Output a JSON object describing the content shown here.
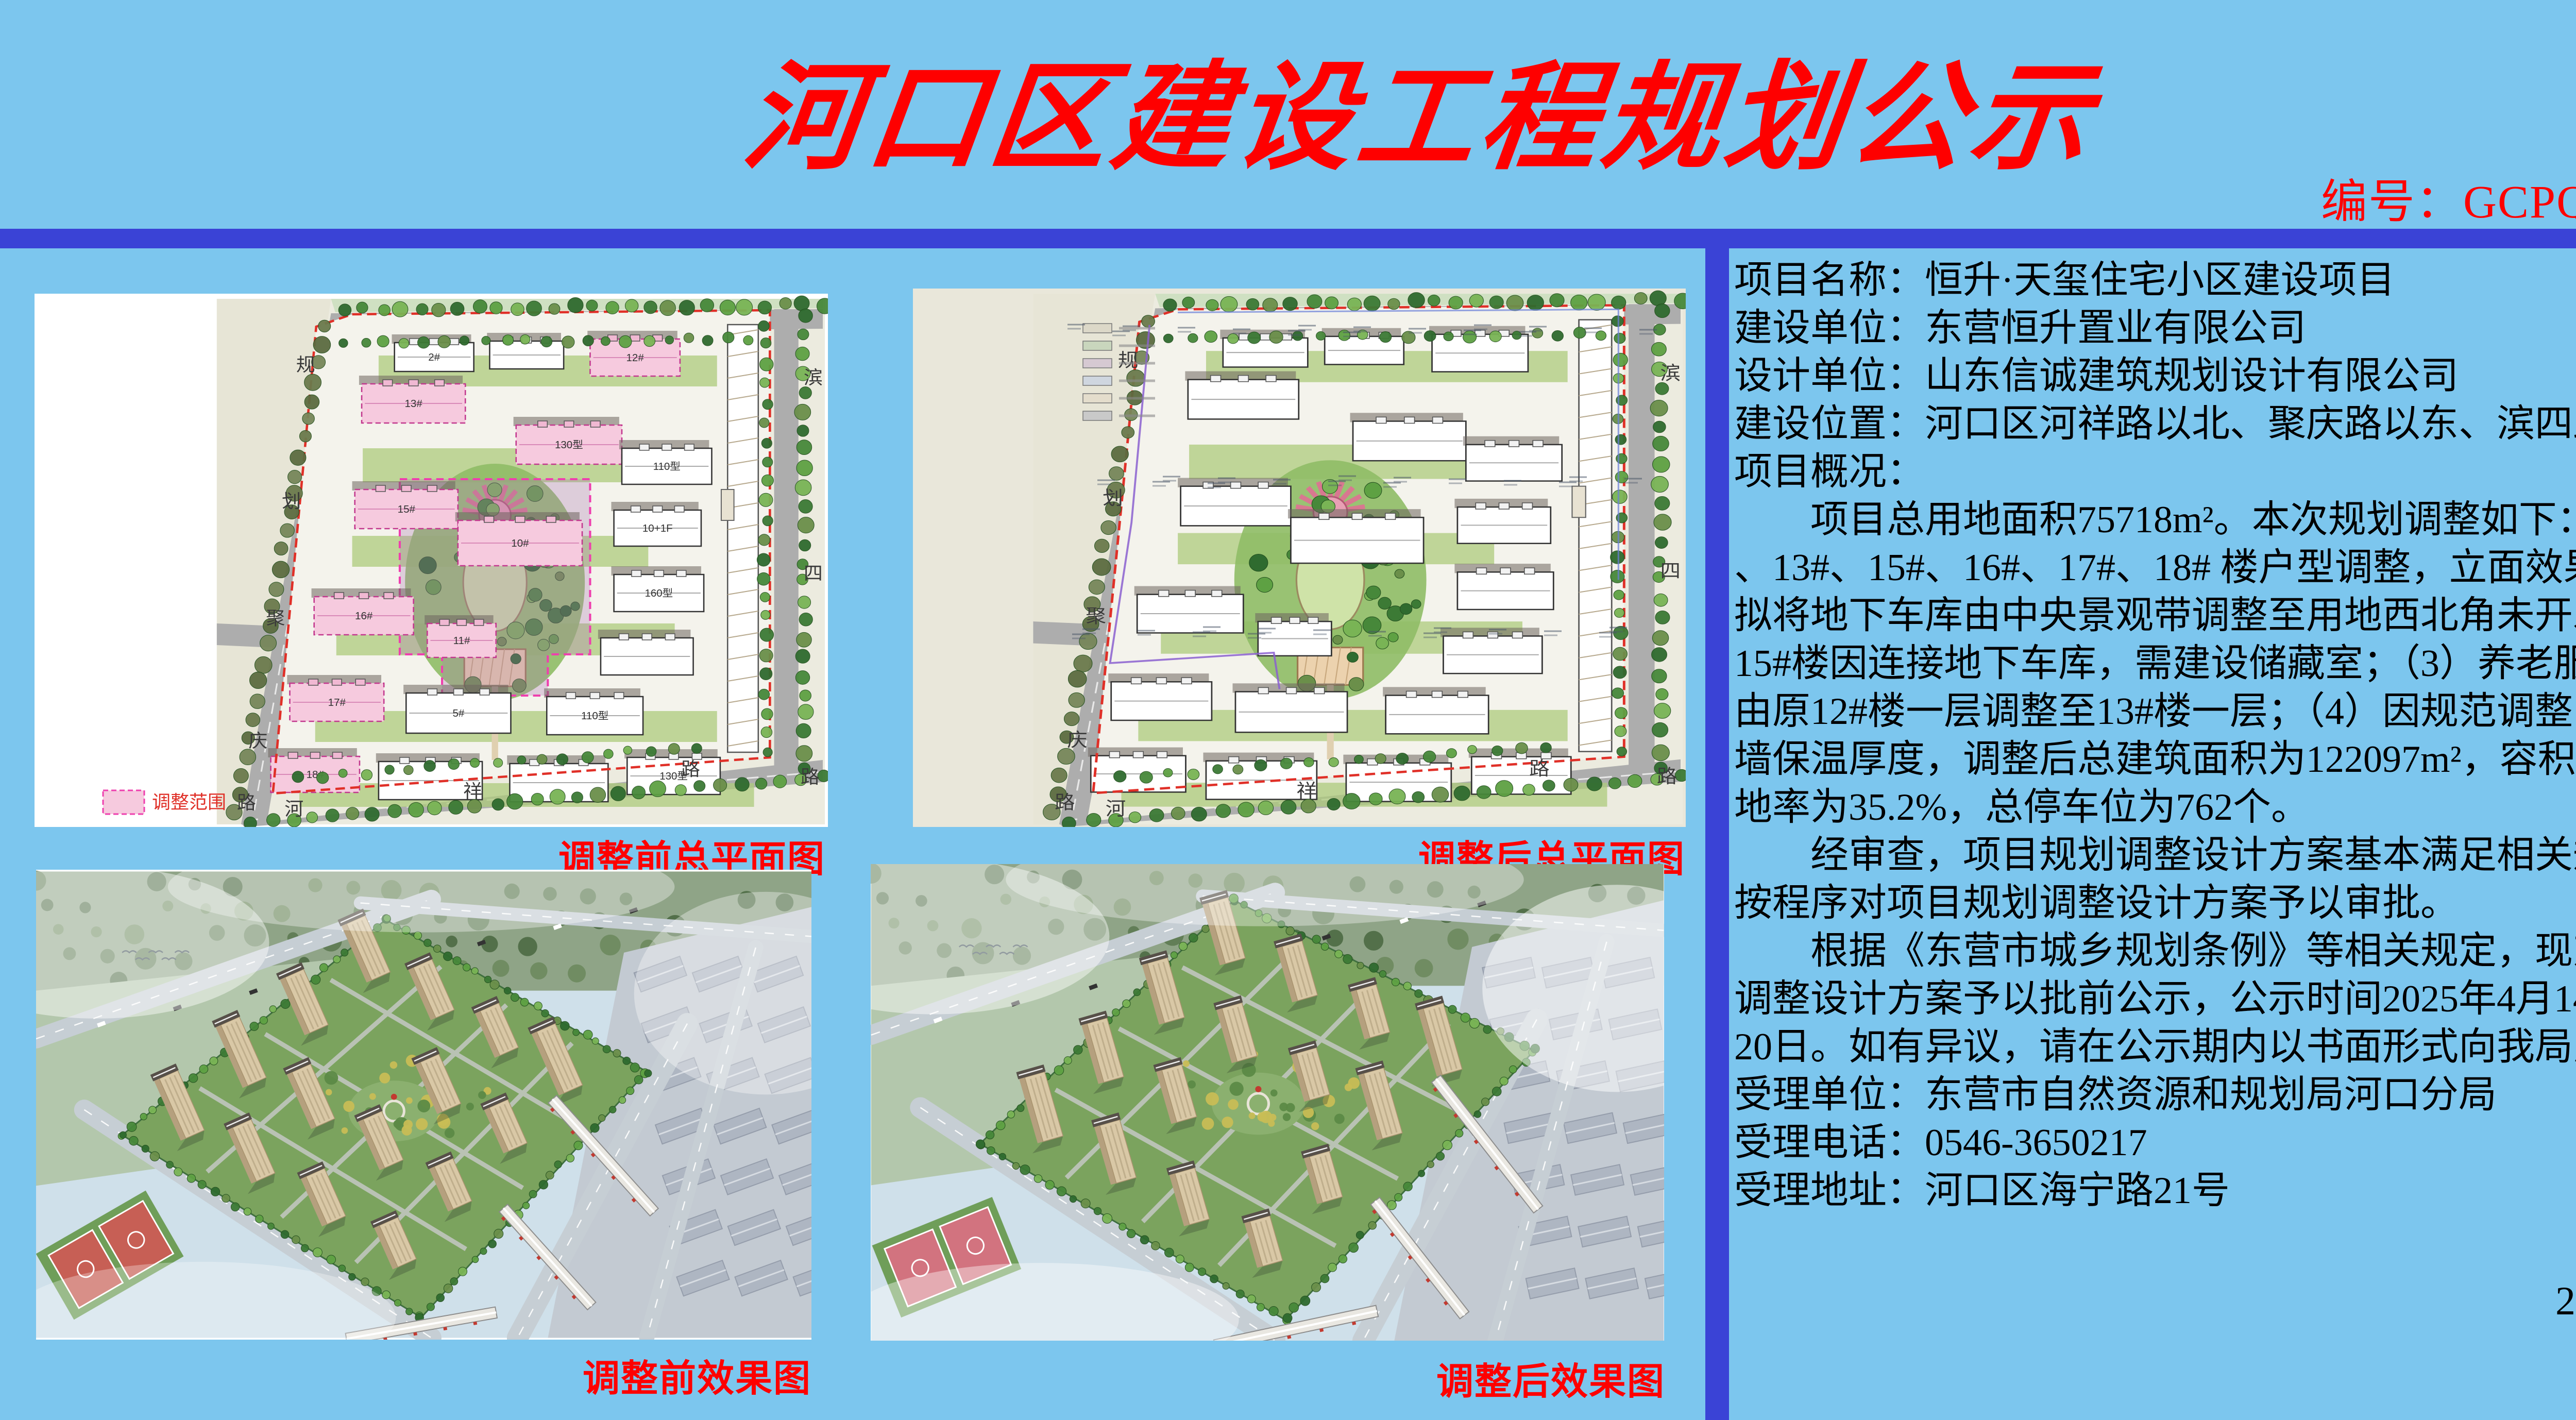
{
  "header": {
    "title": "河口区建设工程规划公示",
    "serial": "编号：GCPQ2025015"
  },
  "panels": {
    "plan_before": {
      "caption": "调整前总平面图",
      "legend_label": "调整范围",
      "road_labels_left": [
        "规",
        "划",
        "聚",
        "庆",
        "路"
      ],
      "road_labels_right": [
        "滨",
        "四",
        "路"
      ],
      "road_labels_bottom": [
        "河",
        "祥",
        "路"
      ],
      "building_labels": [
        "12#",
        "13#",
        "15#",
        "16#",
        "17#",
        "18#",
        "10#",
        "11#",
        "160型",
        "130型",
        "110型",
        "10+1F",
        "5#",
        "2#"
      ]
    },
    "plan_after": {
      "caption": "调整后总平面图",
      "road_labels_left": [
        "规",
        "划",
        "聚",
        "庆",
        "路"
      ],
      "road_labels_right": [
        "滨",
        "四",
        "路"
      ],
      "road_labels_bottom": [
        "河",
        "祥",
        "路"
      ]
    },
    "render_before": {
      "caption": "调整前效果图"
    },
    "render_after": {
      "caption": "调整后效果图"
    }
  },
  "info": {
    "lines": [
      "项目名称：恒升·天玺住宅小区建设项目",
      "建设单位：东营恒升置业有限公司",
      "设计单位：山东信诚建筑规划设计有限公司",
      "建设位置：河口区河祥路以北、聚庆路以东、滨四路以西",
      "项目概况：",
      "　　项目总用地面积75718m²。本次规划调整如下：（1）1#、12#",
      "、13#、15#、16#、17#、18# 楼户型调整，立面效果不变；（2）",
      "拟将地下车库由中央景观带调整至用地西北角未开发地块，13#、",
      "15#楼因连接地下车库，需建设储藏室；（3）养老服务设施用房",
      "由原12#楼一层调整至13#楼一层；（4）因规范调整，对应提高外",
      "墙保温厚度，调整后总建筑面积为122097m²，容积率为1.47，绿",
      "地率为35.2%，总停车位为762个。",
      "　　经审查，项目规划调整设计方案基本满足相关规范要求，拟",
      "按程序对项目规划调整设计方案予以审批。",
      "　　根据《东营市城乡规划条例》等相关规定，现对该项目规划",
      "调整设计方案予以批前公示，公示时间2025年4月14日至2025年4月",
      "20日。如有异议，请在公示期内以书面形式向我局反馈。",
      "受理单位：东营市自然资源和规划局河口分局",
      "受理电话：0546-3650217",
      "受理地址：河口区海宁路21号"
    ]
  },
  "footer": {
    "date": "2025年4月14日"
  },
  "colors": {
    "background": "#7cc6ee",
    "divider": "#3a43d6",
    "title_red": "#fe0000",
    "caption_red": "#fe0000",
    "body_text": "#000000",
    "adjust_pink_fill": "#f6cade",
    "adjust_magenta": "#ee3fae",
    "boundary_red": "#e03028",
    "plan_paper": "#eceadd",
    "render_building_tan": "#d9c8a6"
  }
}
